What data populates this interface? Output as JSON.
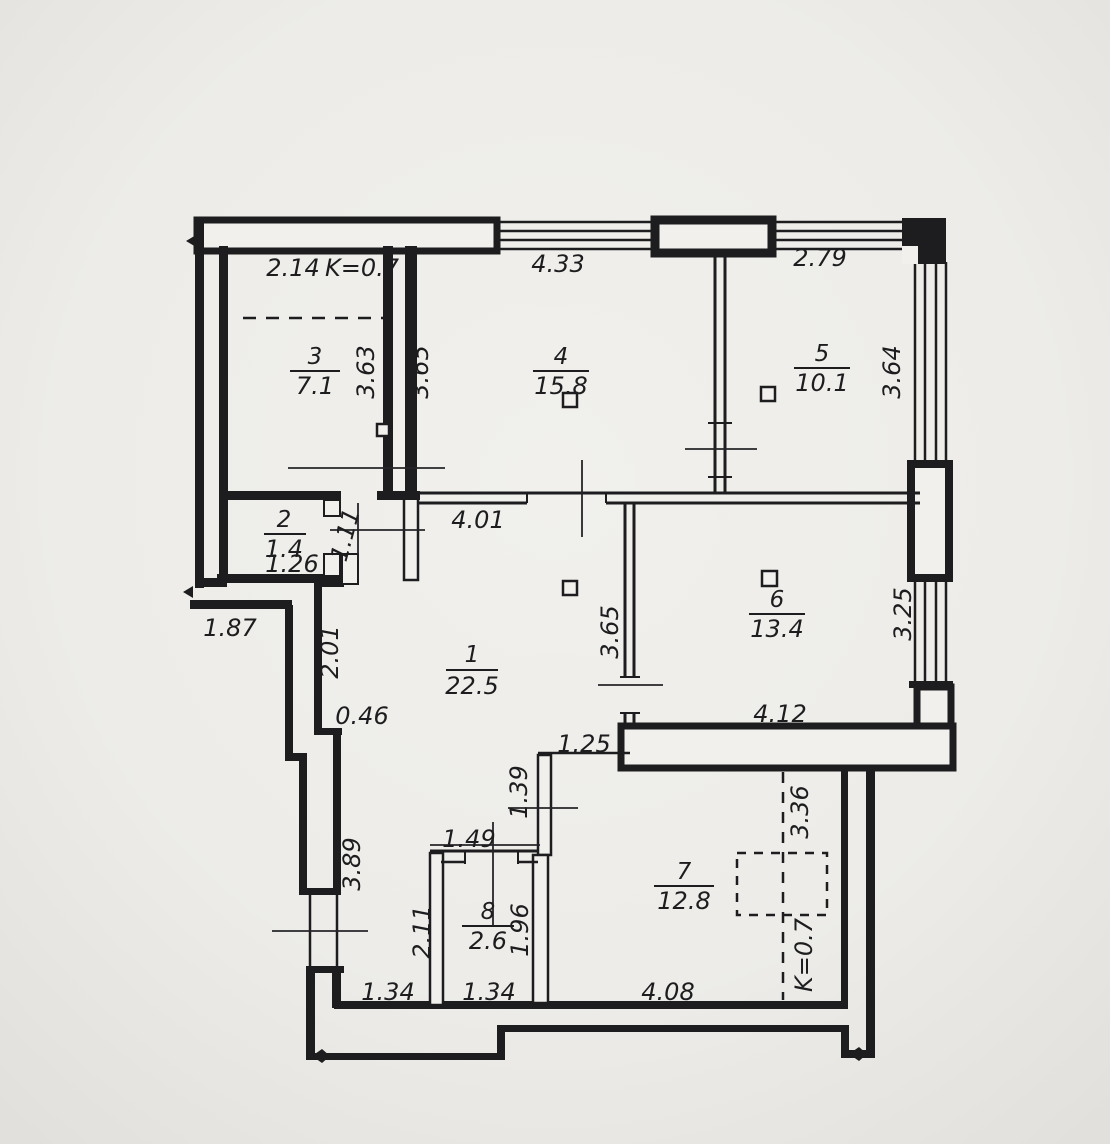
{
  "title": "apartment-floor-plan",
  "colors": {
    "paper": "#f0efec",
    "paper_edge": "#e2e0dc",
    "ink": "#1d1d1f"
  },
  "rooms": {
    "r1": {
      "number": "1",
      "area": "22.5"
    },
    "r2": {
      "number": "2",
      "area": "1.4"
    },
    "r3": {
      "number": "3",
      "area": "7.1"
    },
    "r4": {
      "number": "4",
      "area": "15.8"
    },
    "r5": {
      "number": "5",
      "area": "10.1"
    },
    "r6": {
      "number": "6",
      "area": "13.4"
    },
    "r7": {
      "number": "7",
      "area": "12.8"
    },
    "r8": {
      "number": "8",
      "area": "2.6"
    }
  },
  "dims": {
    "room3_width": "2.14",
    "k_top": "K=0.7",
    "room4_width": "4.33",
    "room5_width": "2.79",
    "room3_depth": "3.63",
    "room4_depth": "3.65",
    "room5_depth": "3.64",
    "room2_width": "1.26",
    "room2_door": "1.11",
    "hall_width": "4.01",
    "ledge": "1.87",
    "wall_upper": "2.01",
    "step": "0.46",
    "hall_wall": "3.65",
    "room6_depth": "3.25",
    "room6_width": "4.12",
    "passage_width": "1.25",
    "passage_depth": "1.39",
    "wall_lower": "3.89",
    "nook_width": "1.49",
    "nook_depth": "2.11",
    "room8_depth": "1.96",
    "nook_width_b": "1.34",
    "room8_width_b": "1.34",
    "room7_width": "4.08",
    "balcony_depth": "3.36",
    "k_bottom": "K=0.7"
  }
}
